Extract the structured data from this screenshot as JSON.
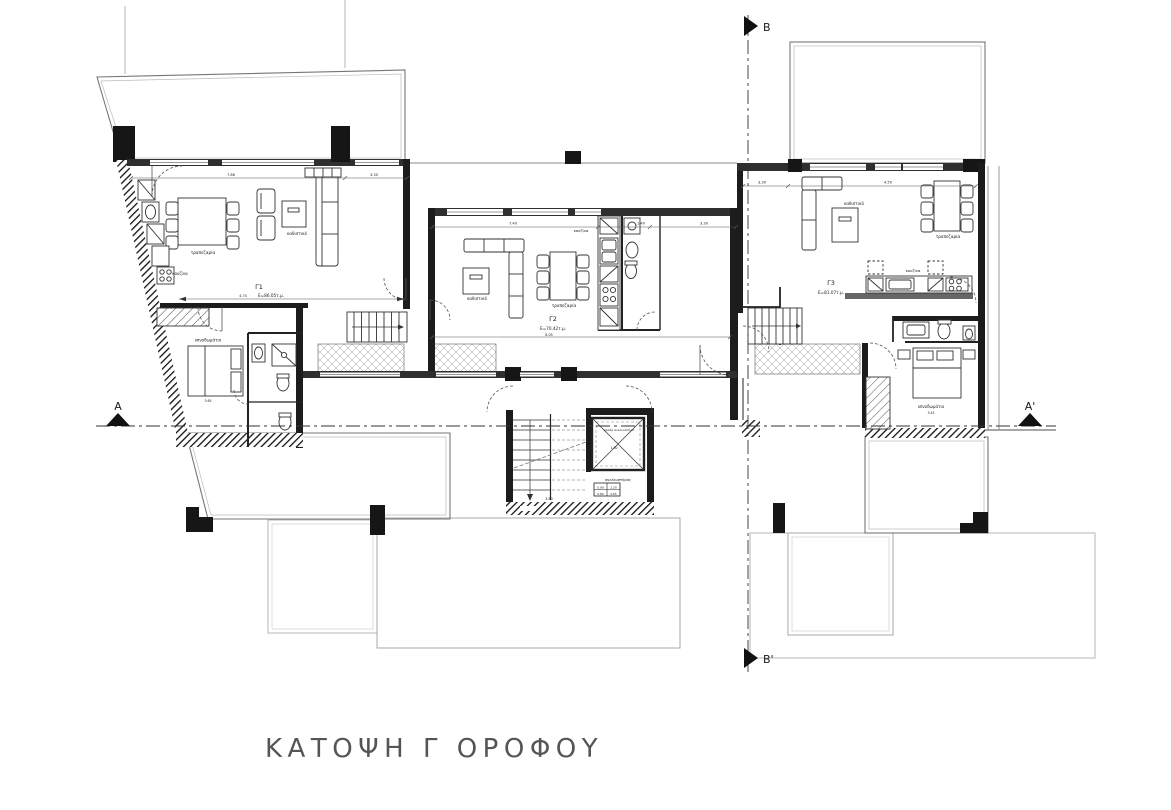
{
  "title": "ΚΑΤΟΨΗ Γ ΟΡΟΦΟΥ",
  "sections": {
    "b_top": "B",
    "b_bottom": "B'",
    "a_left": "A",
    "a_right": "A'"
  },
  "apartments": [
    {
      "id": "Γ1",
      "area": "Ε=86.05τ.μ.",
      "labels": {
        "dining": "τραπεζαρία",
        "kitchen": "κουζίνα",
        "living": "καθιστικό",
        "bedroom": "υπνοδωμάτιο"
      },
      "dims": {
        "d1": "7.86",
        "d2": "3.30",
        "d3": "4.74",
        "d4": "3.65"
      }
    },
    {
      "id": "Γ2",
      "area": "Ε=70.42τ.μ.",
      "labels": {
        "dining": "τραπεζαρία",
        "kitchen": "κουζίνα",
        "living": "καθιστικό"
      },
      "dims": {
        "d1": "7.40",
        "d2": "1.40",
        "d3": "3.30",
        "d4": "8.05"
      }
    },
    {
      "id": "Γ3",
      "area": "Ε=81.07τ.μ.",
      "labels": {
        "dining": "τραπεζαρία",
        "kitchen": "κουζίνα",
        "living": "καθιστικό",
        "bedroom": "υπνοδωμάτιο"
      },
      "dims": {
        "d1": "3.30",
        "d2": "4.50",
        "d3": "3.45"
      }
    }
  ],
  "core": {
    "shaft_label": "φρεάρ ανελκυστήρα",
    "elevator_label": "ανελκυστήρας",
    "table": {
      "r1c1": "0.90",
      "r1c2": "2.20",
      "r2c1": "0.80",
      "r2c2": "2.65"
    },
    "dims": {
      "d1": "1.00",
      "d2": "3.80"
    }
  },
  "colors": {
    "wall": "#1c1c1c",
    "line": "#333333",
    "faint": "#b5b5b5",
    "accent": "#666666",
    "paper": "#ffffff"
  }
}
